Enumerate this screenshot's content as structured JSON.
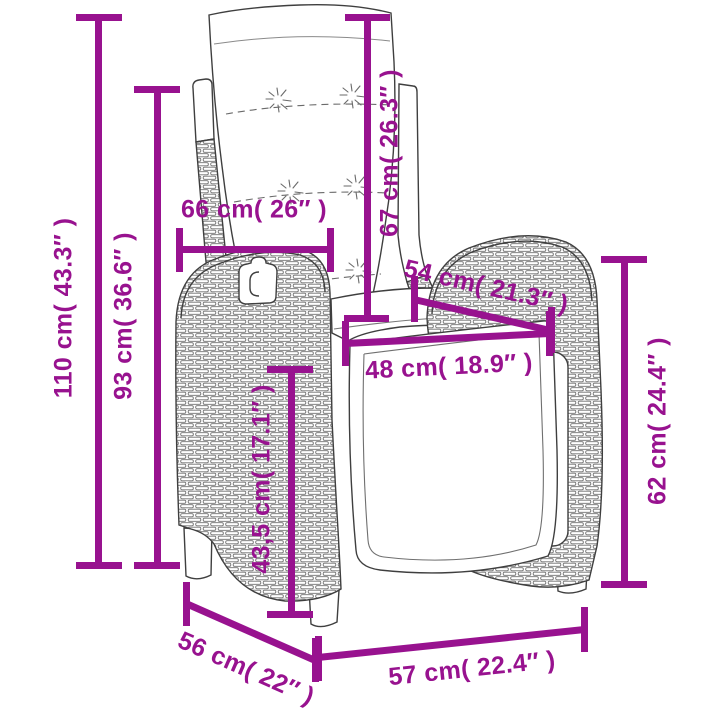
{
  "diagram": {
    "type": "product-dimension-diagram",
    "subject": "reclining wicker garden chair with back cushion, line drawing with measurements"
  },
  "colors": {
    "accent": "#98128F",
    "line_art": "#3F3F3F",
    "background": "#FFFFFF"
  },
  "measurements": [
    {
      "id": "total-height",
      "label": "110 cm( 43.3″ )"
    },
    {
      "id": "backrest-height",
      "label": "93 cm( 36.6″ )"
    },
    {
      "id": "cushion-height",
      "label": "67 cm( 26.3″ )"
    },
    {
      "id": "back-width",
      "label": "66 cm( 26″ )"
    },
    {
      "id": "seat-diagonal",
      "label": "54 cm( 21.3″ )"
    },
    {
      "id": "seat-width",
      "label": "48 cm( 18.9″ )"
    },
    {
      "id": "seat-height",
      "label": "43,5 cm( 17.1″ )"
    },
    {
      "id": "armrest-height",
      "label": "62 cm( 24.4″ )"
    },
    {
      "id": "depth",
      "label": "56 cm( 22″ )"
    },
    {
      "id": "front-width",
      "label": "57 cm( 22.4″ )"
    }
  ]
}
